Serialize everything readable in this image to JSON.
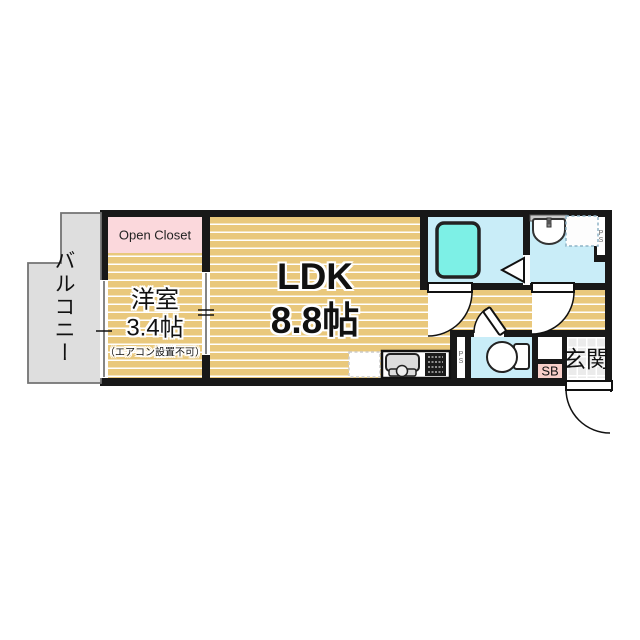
{
  "floorplan": {
    "rooms": {
      "balcony": {
        "label": "バルコニー"
      },
      "open_closet": {
        "label": "Open Closet"
      },
      "western_room": {
        "name": "洋室",
        "size": "3.4帖",
        "note": "（エアコン設置不可）"
      },
      "ldk": {
        "name": "LDK",
        "size": "8.8帖"
      },
      "entrance": {
        "label": "玄関"
      },
      "shoe_box": {
        "label": "SB"
      },
      "pipe_space_kitchen": {
        "label": "PS"
      },
      "pipe_space_washroom": {
        "label": "PS"
      }
    },
    "fixture_icons": [
      "bathtub-icon",
      "bathroom-folding-door-icon",
      "wash-basin-icon",
      "washing-machine-space-icon",
      "toilet-icon",
      "kitchen-sink-icon",
      "gas-stove-icon",
      "refrigerator-space-icon",
      "hinged-door-arc-icon",
      "sliding-window-icon",
      "sliding-door-icon",
      "entrance-door-arc-icon"
    ],
    "colors": {
      "wall": "#181818",
      "floor_wood": "#e9c87c",
      "floor_stripe": "#ffffff",
      "wet_area_floor": "#c9edf8",
      "bathtub": "#7df0e6",
      "closet_pink": "#fbd8dc",
      "shoe_box_pink": "#f8cfc9",
      "balcony_gray": "#dedede",
      "entrance_tile": "#ebebeb"
    }
  }
}
